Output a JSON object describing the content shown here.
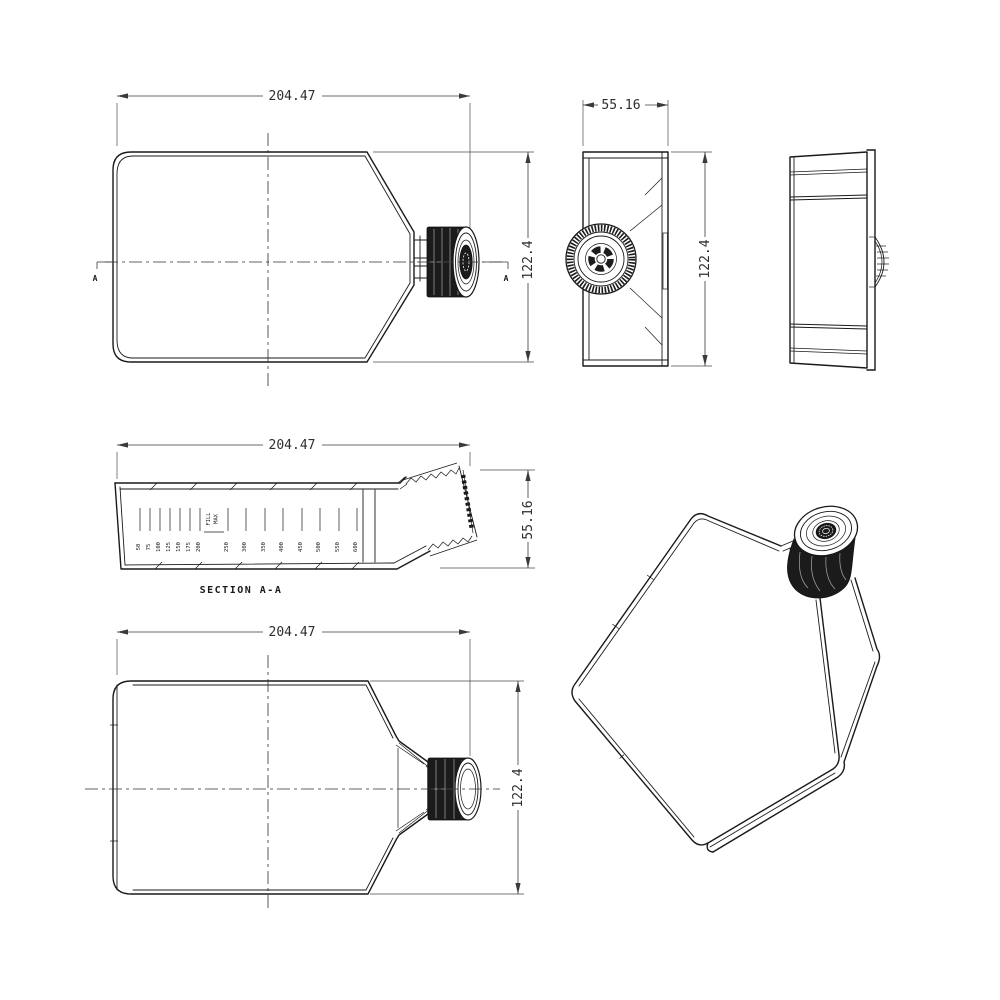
{
  "colors": {
    "background": "#ffffff",
    "line": "#1a1a1a",
    "dimension": "#3a3a3a",
    "cap_dark": "#1b1b1b"
  },
  "views": {
    "front": {
      "width": "204.47",
      "height": "122.4",
      "section_letter": "A"
    },
    "side": {
      "width": "55.16",
      "height": "122.4"
    },
    "rear": {},
    "section": {
      "width": "204.47",
      "height": "55.16",
      "caption": "SECTION A-A",
      "max_fill": {
        "left": "FILL",
        "right": "MAX"
      },
      "grads_fine": [
        "50",
        "75",
        "100",
        "125",
        "150",
        "175",
        "200"
      ],
      "grads_coarse": [
        "250",
        "300",
        "350",
        "400",
        "450",
        "500",
        "550",
        "600"
      ]
    },
    "bottom": {
      "width": "204.47",
      "height": "122.4"
    },
    "iso": {}
  }
}
